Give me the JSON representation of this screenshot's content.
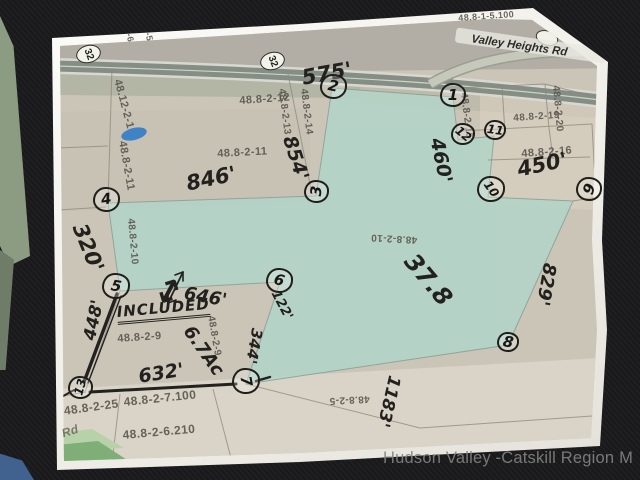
{
  "photo": {
    "background_color": "#1a1a1c",
    "watermark": "Hudson Valley -Catskill Region M"
  },
  "map": {
    "subject_parcel_fill": "#b3d4c8",
    "roads": {
      "route_shield": "32",
      "street_label": "Valley Heights Rd"
    },
    "parcel_labels": [
      {
        "text": "48.8-1-5.100",
        "x": 458,
        "y": 13,
        "rot": -4,
        "size": 9
      },
      {
        "text": "1-5",
        "x": 152,
        "y": 26,
        "rot": 78,
        "size": 9
      },
      {
        "text": "1-6",
        "x": 133,
        "y": 27,
        "rot": 78,
        "size": 9
      },
      {
        "text": "48.12-2-1",
        "x": 123,
        "y": 78,
        "rot": 75,
        "size": 11
      },
      {
        "text": "48.8-2-11",
        "x": 128,
        "y": 140,
        "rot": 80,
        "size": 11
      },
      {
        "text": "48.8-2-12",
        "x": 239,
        "y": 95,
        "rot": -4,
        "size": 11
      },
      {
        "text": "48.8-2-13",
        "x": 287,
        "y": 88,
        "rot": 83,
        "size": 10
      },
      {
        "text": "48.8-2-14",
        "x": 309,
        "y": 88,
        "rot": 83,
        "size": 10
      },
      {
        "text": "48.8-2-15",
        "x": 469,
        "y": 92,
        "rot": 83,
        "size": 10
      },
      {
        "text": "48.8-2-19",
        "x": 513,
        "y": 113,
        "rot": -4,
        "size": 10
      },
      {
        "text": "48.8-2-20",
        "x": 561,
        "y": 85,
        "rot": 85,
        "size": 10
      },
      {
        "text": "48.8-2-16",
        "x": 521,
        "y": 148,
        "rot": -4,
        "size": 11
      },
      {
        "text": "48.8-2-11",
        "x": 217,
        "y": 148,
        "rot": -3,
        "size": 11
      },
      {
        "text": "48.8-2-10",
        "x": 136,
        "y": 218,
        "rot": 85,
        "size": 10
      },
      {
        "text": "48.8-2-10",
        "x": 417,
        "y": 245,
        "rot": 183,
        "size": 10
      },
      {
        "text": "48.8-2-9",
        "x": 117,
        "y": 333,
        "rot": -4,
        "size": 11
      },
      {
        "text": "48.8-2-9",
        "x": 216,
        "y": 315,
        "rot": 80,
        "size": 10
      },
      {
        "text": "48.8-2-25",
        "x": 63,
        "y": 404,
        "rot": -8,
        "size": 12
      },
      {
        "text": "48.8-2-7.100",
        "x": 123,
        "y": 395,
        "rot": -6,
        "size": 12
      },
      {
        "text": "48.8-2-6.210",
        "x": 122,
        "y": 428,
        "rot": -5,
        "size": 12
      },
      {
        "text": "48.8-2-5",
        "x": 370,
        "y": 404,
        "rot": 177,
        "size": 10
      },
      {
        "text": "Rd",
        "x": 60,
        "y": 427,
        "rot": -18,
        "size": 12,
        "italic": true
      }
    ]
  },
  "annotations": {
    "measurements": [
      {
        "text": "575'",
        "x": 300,
        "y": 66,
        "rot": -10,
        "size": 21
      },
      {
        "text": "854'",
        "x": 299,
        "y": 133,
        "rot": 72,
        "size": 19
      },
      {
        "text": "846'",
        "x": 184,
        "y": 172,
        "rot": -12,
        "size": 21
      },
      {
        "text": "460'",
        "x": 447,
        "y": 136,
        "rot": 78,
        "size": 19
      },
      {
        "text": "450'",
        "x": 515,
        "y": 158,
        "rot": -12,
        "size": 21
      },
      {
        "text": "320'",
        "x": 90,
        "y": 220,
        "rot": 68,
        "size": 21
      },
      {
        "text": "646'",
        "x": 186,
        "y": 283,
        "rot": 10,
        "size": 18
      },
      {
        "text": "122'",
        "x": 281,
        "y": 288,
        "rot": 62,
        "size": 13
      },
      {
        "text": "344'",
        "x": 266,
        "y": 330,
        "rot": 100,
        "size": 15
      },
      {
        "text": "829'",
        "x": 560,
        "y": 265,
        "rot": 100,
        "size": 18
      },
      {
        "text": "1183'",
        "x": 404,
        "y": 378,
        "rot": 103,
        "size": 17
      },
      {
        "text": "632'",
        "x": 137,
        "y": 366,
        "rot": -9,
        "size": 19
      },
      {
        "text": "448'",
        "x": 80,
        "y": 338,
        "rot": -78,
        "size": 17
      }
    ],
    "notes": [
      {
        "text": "INCLUDED",
        "x": 116,
        "y": 303,
        "rot": -5,
        "size": 15,
        "underline": true
      },
      {
        "text": "6.7Ac",
        "x": 196,
        "y": 322,
        "rot": 55,
        "size": 18
      },
      {
        "text": "37.8",
        "x": 420,
        "y": 248,
        "rot": 50,
        "size": 24
      },
      {
        "text": "↕",
        "x": 165,
        "y": 268,
        "rot": 28,
        "size": 34,
        "arrow": true
      }
    ],
    "corner_markers": [
      {
        "n": "1",
        "x": 453,
        "y": 96,
        "d": 26,
        "rot": 0
      },
      {
        "n": "2",
        "x": 333,
        "y": 87,
        "d": 27,
        "rot": 12
      },
      {
        "n": "3",
        "x": 316,
        "y": 192,
        "d": 25,
        "rot": -85
      },
      {
        "n": "4",
        "x": 106,
        "y": 200,
        "d": 27,
        "rot": -8
      },
      {
        "n": "5",
        "x": 116,
        "y": 287,
        "d": 28,
        "rot": 10
      },
      {
        "n": "6",
        "x": 279,
        "y": 281,
        "d": 27,
        "rot": 15
      },
      {
        "n": "7",
        "x": 246,
        "y": 382,
        "d": 28,
        "rot": 80
      },
      {
        "n": "8",
        "x": 508,
        "y": 343,
        "d": 22,
        "rot": 10
      },
      {
        "n": "9",
        "x": 589,
        "y": 190,
        "d": 26,
        "rot": -70
      },
      {
        "n": "10",
        "x": 491,
        "y": 190,
        "d": 28,
        "rot": 55
      },
      {
        "n": "11",
        "x": 495,
        "y": 131,
        "d": 22,
        "rot": 8
      },
      {
        "n": "12",
        "x": 463,
        "y": 135,
        "d": 24,
        "rot": 40
      },
      {
        "n": "13",
        "x": 80,
        "y": 388,
        "d": 25,
        "rot": -75
      }
    ]
  }
}
